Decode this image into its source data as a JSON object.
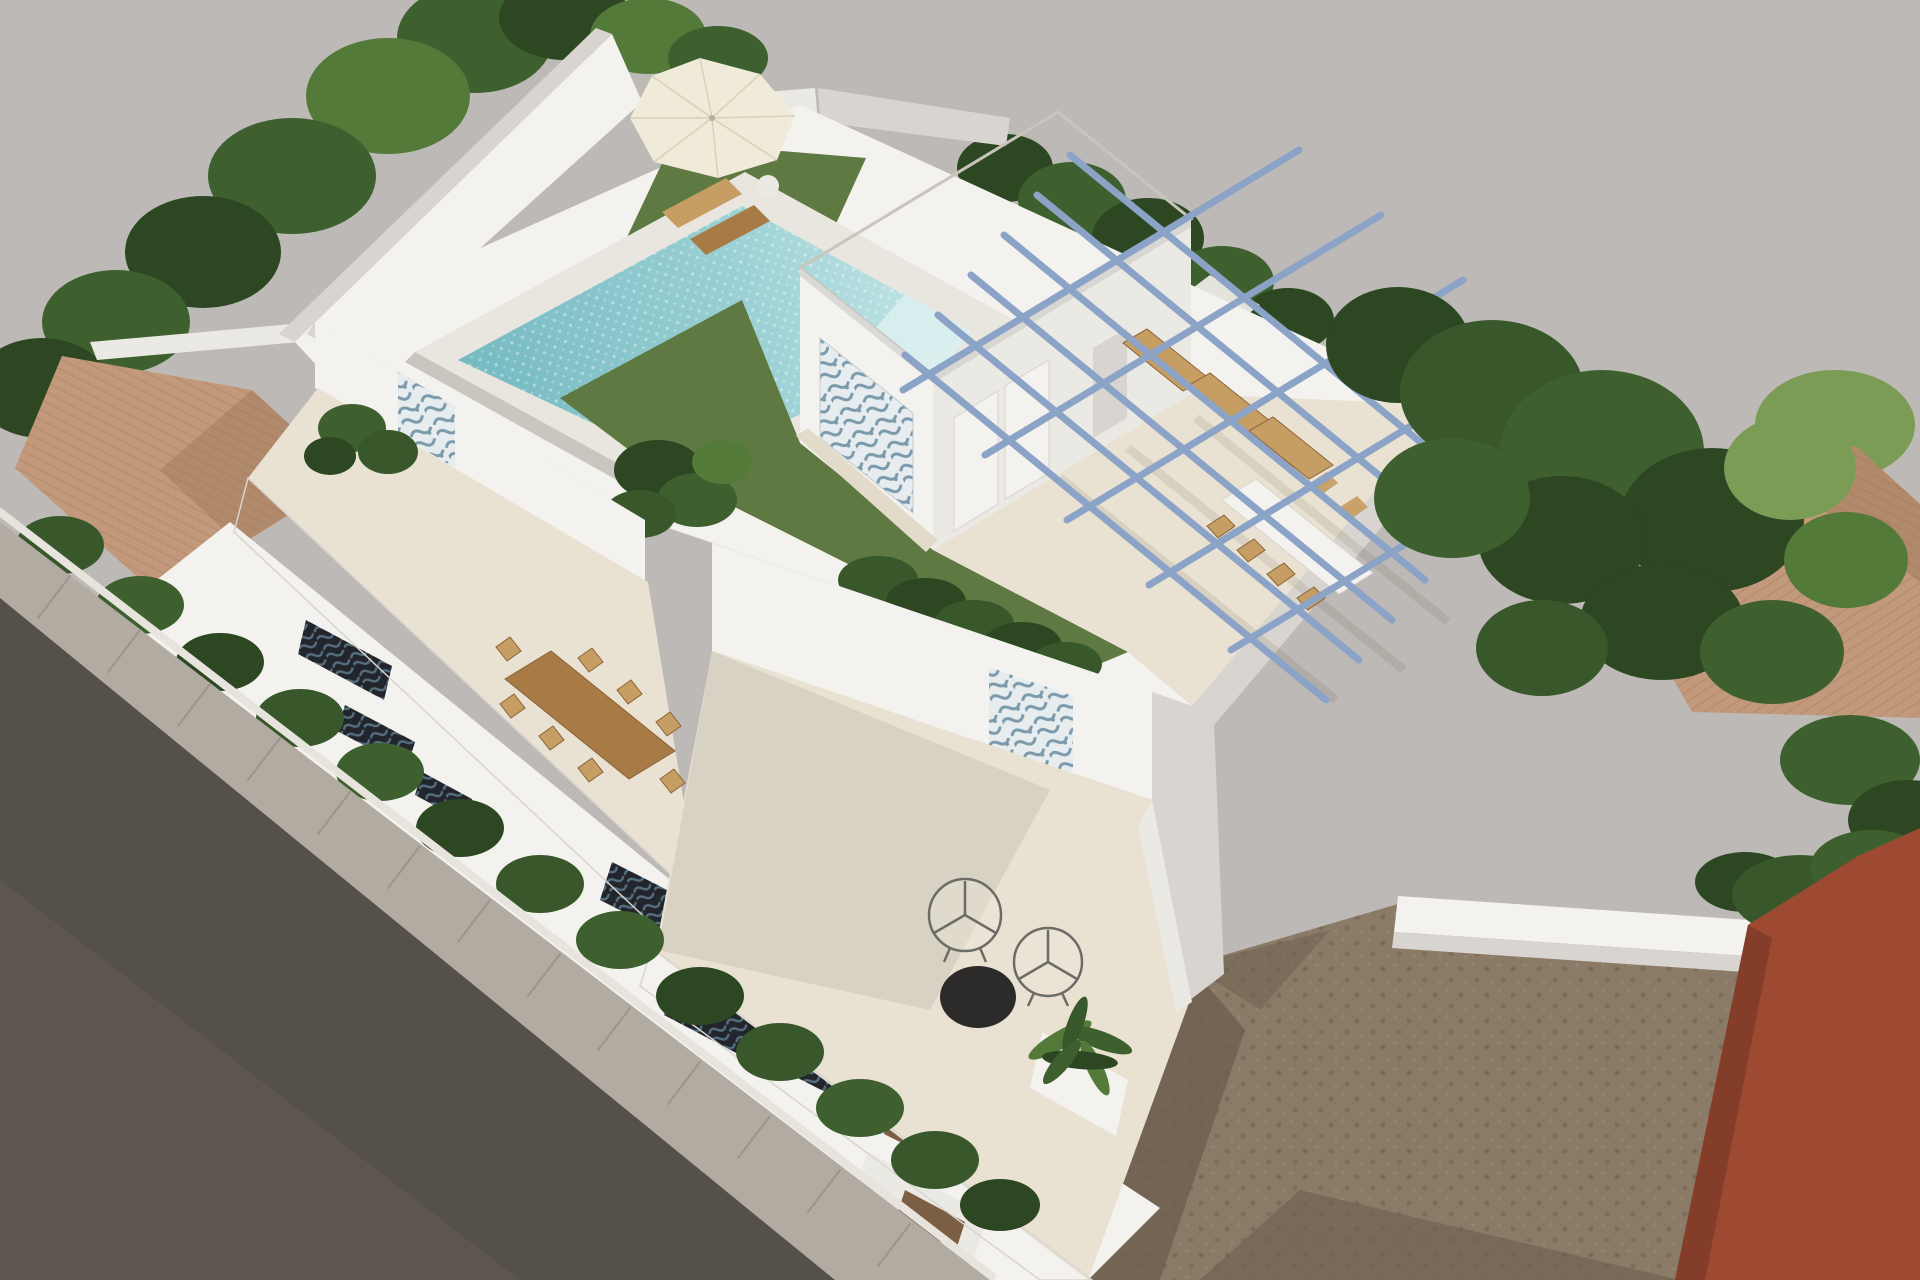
{
  "scene": {
    "type": "3d-architectural-rendering",
    "view": "aerial-isometric",
    "subject": "Aerial 3D rendering of a modern two-storey white villa with rooftop pool, roof lawn, penthouse, blue steel pergola and street-side terraces",
    "setting": "Residential block with neighbouring terracotta roofs, trees and hedges, sidewalk and asphalt road at lower left, vacant dirt lot and red building at lower right"
  },
  "objects": [
    {
      "name": "villa",
      "label": "Modern white villa"
    },
    {
      "name": "rooftop-pool",
      "label": "Rooftop swimming pool"
    },
    {
      "name": "parasol",
      "label": "Patio umbrella with sun loungers"
    },
    {
      "name": "penthouse",
      "label": "Rooftop penthouse with mosaic accent wall"
    },
    {
      "name": "pergola",
      "label": "Blue steel pergola frame"
    },
    {
      "name": "rooftop-dining-set",
      "label": "White dining table with wicker chairs"
    },
    {
      "name": "terrace-dining-set",
      "label": "Wooden dining table for eight"
    },
    {
      "name": "acapulco-chairs",
      "label": "Round wire lounge chairs with black coffee table"
    },
    {
      "name": "roof-lawn",
      "label": "Roof garden lawn with tropical plants and hedge"
    },
    {
      "name": "neighbour-roof-left",
      "label": "Neighbouring terracotta hip roof"
    },
    {
      "name": "neighbour-roof-right",
      "label": "Neighbouring terracotta roof among trees"
    },
    {
      "name": "vacant-lot",
      "label": "Vacant dirt lot"
    },
    {
      "name": "red-building",
      "label": "Red rendered building corner"
    },
    {
      "name": "sidewalk",
      "label": "Paved sidewalk"
    },
    {
      "name": "road",
      "label": "Asphalt road"
    }
  ],
  "palette": {
    "bg": "#bdb9b6",
    "white_lit": "#f4f2ef",
    "white_soft": "#ebe9e4",
    "white_shade": "#d8d4cf",
    "white_dim": "#c9c5bf",
    "terrace_cream": "#e9e2d3",
    "terrace_cream2": "#f2ecdf",
    "path_beige": "#e3dbc9",
    "roof_speckle": "#d7d2ca",
    "speckle_dot": "#c3bdb3",
    "pool_deep": "#74b9c1",
    "pool_mid": "#98cfd3",
    "pool_light": "#c8e8e9",
    "pool_step": "#d9f0f0",
    "coping": "#e9e6e0",
    "lawn": "#5e7942",
    "tree_dark": "#2c4722",
    "tree_mid": "#3e602f",
    "tree_light": "#547a3a",
    "tree_pale": "#7a9c55",
    "hedge": "#38582b",
    "terracotta": "#c2997a",
    "terracotta2": "#b18a6c",
    "terracotta3": "#cfa98b",
    "tile_line": "#96704f",
    "pergola": "#8ba3c6",
    "wood": "#a87a46",
    "wood_light": "#c69e64",
    "wood_dark": "#8a6336",
    "wood_slat": "#7c5e45",
    "glass": "#d8d5d1",
    "mosaic_bg": "#e7edef",
    "mosaic_fg": "#7b9aac",
    "dark_bg": "#23252c",
    "dark_fg": "#546e7d",
    "dirt": "#8b7a66",
    "dirt_dark": "#6d5f50",
    "red_wall": "#9e4a32",
    "red_dark": "#843d29",
    "road": "#56504a",
    "road_light": "#635c55",
    "sidewalk": "#b2aba1",
    "sidewalk_line": "#978f84",
    "curb": "#e7e4de",
    "umbrella": "#f0ead8",
    "black_obj": "#2d2b29"
  }
}
